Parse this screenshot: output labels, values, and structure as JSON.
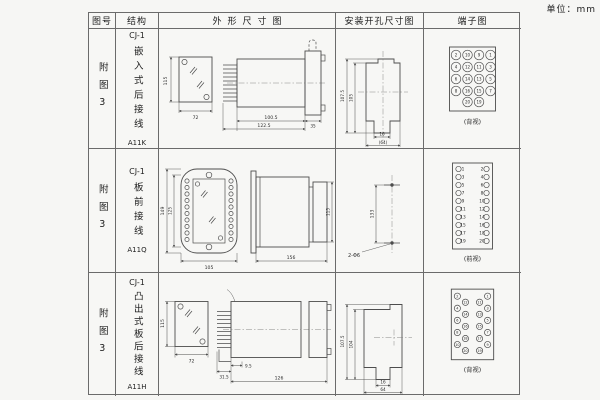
{
  "unit_note": "单位：mm",
  "table": {
    "headers": {
      "figure_no": "图号",
      "structure": "结构",
      "outline": "外形尺寸图",
      "install": "安装开孔尺寸图",
      "terminal": "端子图"
    }
  },
  "rows": [
    {
      "figure_no": "附图3",
      "structure": {
        "model": "CJ-1",
        "type": "嵌入式后接线",
        "code": "A11K"
      },
      "outline": {
        "front_height": "115",
        "front_width": "72",
        "body_depth": "100.5",
        "total_depth": "122.5",
        "flange_depth": "35"
      },
      "install": {
        "outer_height": "107.5",
        "inner_height": "105",
        "slot_width": "16",
        "overall_width": "(64)"
      },
      "terminal": {
        "caption": "(背视)",
        "grid": [
          [
            "2",
            "10",
            "9",
            "1"
          ],
          [
            "4",
            "12",
            "11",
            "3"
          ],
          [
            "6",
            "14",
            "13",
            "5"
          ],
          [
            "8",
            "16",
            "15",
            "7"
          ],
          [
            "20",
            "19"
          ]
        ]
      }
    },
    {
      "figure_no": "附图3",
      "structure": {
        "model": "CJ-1",
        "type": "板前接线",
        "code": "A11Q"
      },
      "outline": {
        "front_height": "149",
        "window_height": "125",
        "front_width": "105",
        "body_depth": "156",
        "side_height": "115"
      },
      "install": {
        "hole_spacing": "133",
        "holes_label": "2-Φ6"
      },
      "terminal": {
        "caption": "(前视)",
        "left_numbers": [
          "1",
          "3",
          "5",
          "7",
          "9",
          "11",
          "13",
          "15",
          "17",
          "19"
        ],
        "right_numbers": [
          "2",
          "4",
          "6",
          "8",
          "10",
          "12",
          "14",
          "16",
          "18",
          "20"
        ]
      }
    },
    {
      "figure_no": "附图3",
      "structure": {
        "model": "CJ-1",
        "type": "凸出式板后接线",
        "code": "A11H"
      },
      "outline": {
        "front_height": "115",
        "front_width": "72",
        "pin_depth": "31.5",
        "panel_offset": "9.5",
        "body_depth": "126"
      },
      "install": {
        "outer_height": "107.5",
        "inner_height": "104",
        "slot_width": "16",
        "overall_width": "64"
      },
      "terminal": {
        "caption": "(背视)",
        "left_outer": [
          "2",
          "4",
          "6",
          "8",
          "10"
        ],
        "left_inner": [
          "12",
          "14",
          "16",
          "18",
          "20"
        ],
        "right_inner": [
          "11",
          "13",
          "15",
          "17",
          "19"
        ],
        "right_outer": [
          "1",
          "3",
          "5",
          "7",
          "9"
        ]
      }
    }
  ]
}
